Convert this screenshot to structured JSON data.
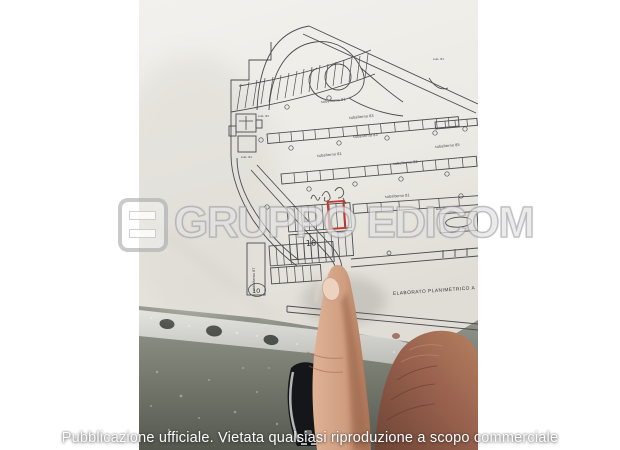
{
  "watermark": {
    "brand": "GRUPPO EDICOM"
  },
  "caption": "Pubblicazione ufficiale. Vietata qualsiasi riproduzione a scopo commerciale",
  "plan": {
    "title": "ELABORATO PLANIMETRICO A",
    "labels": {
      "fan_row": "subalterno 81",
      "strip_a_top": "subalterno 83",
      "strip_a_bottom": "subalterno 83",
      "lane_left": "subalterno 81",
      "lane_right": "subalterno 85",
      "strip_b_bottom": "subalterno 82",
      "center_row": "subalterno 81",
      "right_block": "sub. 84",
      "vertical_block": "subalterno 87",
      "micro_1": "sub. 81",
      "micro_2": "sub. 81",
      "micro_3": "sub. 61"
    },
    "handwritten": {
      "count": "16",
      "circled": "10"
    },
    "highlight_color": "#c5352c"
  },
  "photo_colors": {
    "paper": "#efede8",
    "carpet": "#7d8177",
    "shoe": "#16181b",
    "skin": "#c99479"
  }
}
